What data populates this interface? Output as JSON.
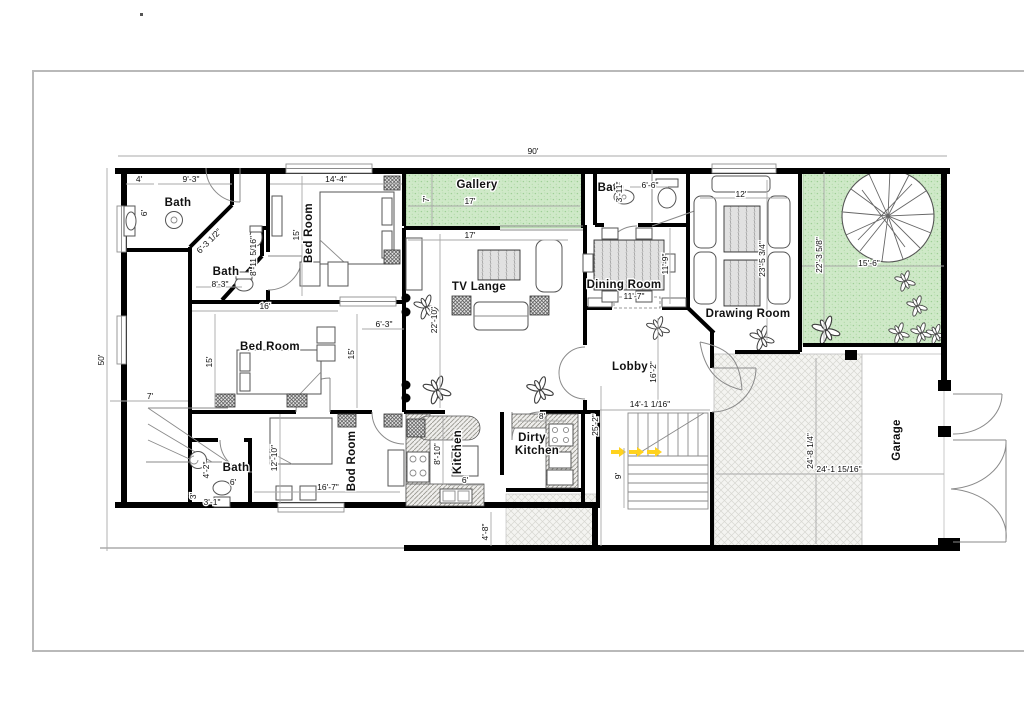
{
  "page": {
    "corner_dot": "."
  },
  "labels": {
    "bath_tl": "Bath",
    "bath_tl2": "Bath",
    "bed_top": "Bed Room",
    "gallery": "Gallery",
    "tv": "TV Lange",
    "bath_tr": "Bath",
    "dining": "Dining Room",
    "drawing": "Drawing Room",
    "bed_mid": "Bed Room",
    "lobby": "Lobby",
    "bed_bot": "Bod Room",
    "bath_b": "Bath",
    "kitchen": "Kitchen",
    "dirty_l1": "Dirty",
    "dirty_l2": "Kitchen",
    "garage": "Garage"
  },
  "dims": {
    "overall_w": "90'",
    "overall_h": "50'",
    "passage_w": "7'",
    "bath1_a": "4'",
    "bath1_b": "9'-3\"",
    "bath1_c": "6'",
    "bath1_diag": "6'-3 1/2\"",
    "bath1_v": "8'-11 5/16\"",
    "bath2_w": "8'-3\"",
    "bed1_w": "14'-4\"",
    "bed1_h": "15'",
    "bed2_w": "16'",
    "bed2_h1": "15'",
    "bed2_h2": "15'",
    "bed2_r": "6'-3\"",
    "gallery_h": "7'",
    "gallery_w": "17'",
    "tv_w": "17'",
    "tv_h": "22'-10\"",
    "bath3_h": "3'-11\"",
    "bath3_w": "6'-6\"",
    "dining_h": "11'-9\"",
    "dining_w": "11'-7\"",
    "drawing_w": "12'",
    "drawing_h": "23'-5 3/4\"",
    "garden_h": "22'-3 5/8\"",
    "garden_w": "15'-6\"",
    "lobby_h": "16'-2\"",
    "lobby_w": "14'-1 1/16\"",
    "hall_h": "25'-2\"",
    "stairs_w": "9'",
    "bed3_h": "12'-10\"",
    "bed3_w": "16'-7\"",
    "bath4_a": "4'-2\"",
    "bath4_b": "3'",
    "bath4_c": "3'-1\"",
    "bath4_d": "6'",
    "kitchen_h": "8'-10\"",
    "kitchen_w": "6'",
    "dirty_w": "8'",
    "back_gap": "4'-8\"",
    "patio_h": "24'-8 1/4\"",
    "patio_w": "24'-1 15/16\""
  }
}
